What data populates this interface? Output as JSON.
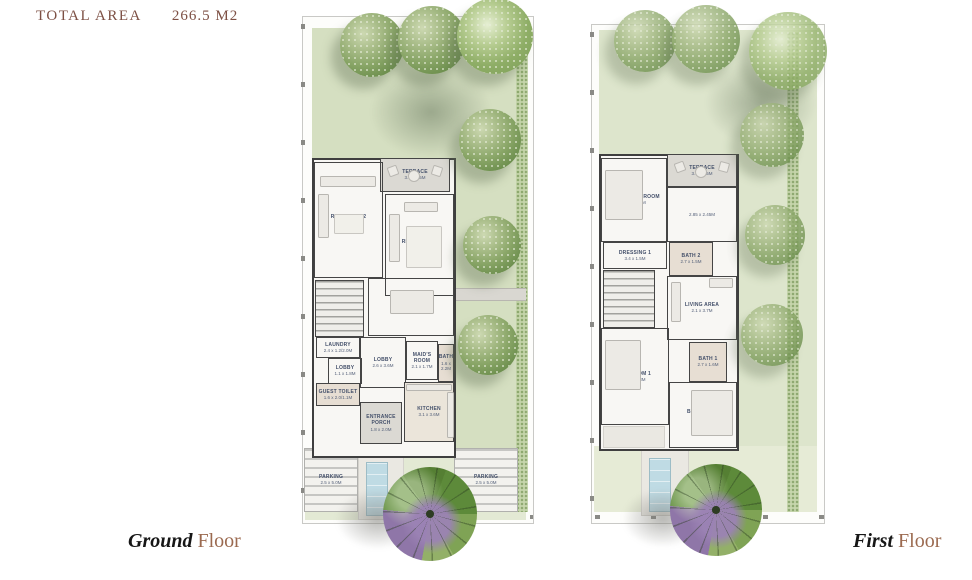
{
  "header": {
    "label": "TOTAL AREA",
    "value": "266.5 M2"
  },
  "floors": [
    {
      "caption_primary": "Ground",
      "caption_secondary": "Floor",
      "rooms": [
        {
          "label": "TERRACE",
          "dims": "3.5 x 1.5M"
        },
        {
          "label": "RECEPTION 2",
          "dims": "3.85 x 4.2M"
        },
        {
          "label": "RECEPTION 1",
          "dims": "3.75 x 4.6M"
        },
        {
          "label": "DINING",
          "dims": "3.8 x 3.7M"
        },
        {
          "label": "LAUNDRY",
          "dims": "2.4 x 1.2/2.0M"
        },
        {
          "label": "LOBBY",
          "dims": "2.6 x 3.6M"
        },
        {
          "label": "MAID'S ROOM",
          "dims": "2.1 x 1.7M"
        },
        {
          "label": "BATH",
          "dims": "1.6 x 2.2M"
        },
        {
          "label": "LOBBY",
          "dims": "1.1 x 1.8M"
        },
        {
          "label": "GUEST TOILET",
          "dims": "1.6 x 2.0/1.1M"
        },
        {
          "label": "KITCHEN",
          "dims": "3.1 x 3.6M"
        },
        {
          "label": "ENTRANCE PORCH",
          "dims": "1.8 x 2.0M"
        },
        {
          "label": "PARKING",
          "dims": "2.5 x 5.0M"
        },
        {
          "label": "PARKING",
          "dims": "2.5 x 5.0M"
        }
      ]
    },
    {
      "caption_primary": "First",
      "caption_secondary": "Floor",
      "rooms": [
        {
          "label": "TERRACE",
          "dims": "3.5 x 1.5M"
        },
        {
          "label": "MASTER BEDROOM",
          "dims": "3.85 x 4.2M"
        },
        {
          "label": "",
          "dims": "2.85 x 2.45M"
        },
        {
          "label": "DRESSING 1",
          "dims": "3.4 x 1.5M"
        },
        {
          "label": "BATH 2",
          "dims": "2.7 x 1.5M"
        },
        {
          "label": "LIVING AREA",
          "dims": "2.1 x 3.7M"
        },
        {
          "label": "BATH 1",
          "dims": "2.7 x 1.6M"
        },
        {
          "label": "BEDROOM 1",
          "dims": "4.1 x 3.3M"
        },
        {
          "label": "BEDROOM 2",
          "dims": "4.1 x 4.2M"
        }
      ]
    }
  ],
  "colors": {
    "title_text": "#7d5044",
    "caption_name": "#161616",
    "caption_floor": "#9b6a50",
    "garden_green": "#d5dfc1",
    "garden_green_faded": "#dde5cc",
    "wall_dark": "#3f3f3f",
    "room_label": "#44506a",
    "tree_green": "#6d8f4e",
    "ornamental_tree_purple": "#9b82b4",
    "pool_blue": "#bfdbe4",
    "paving_gray": "#dbd9d3"
  }
}
